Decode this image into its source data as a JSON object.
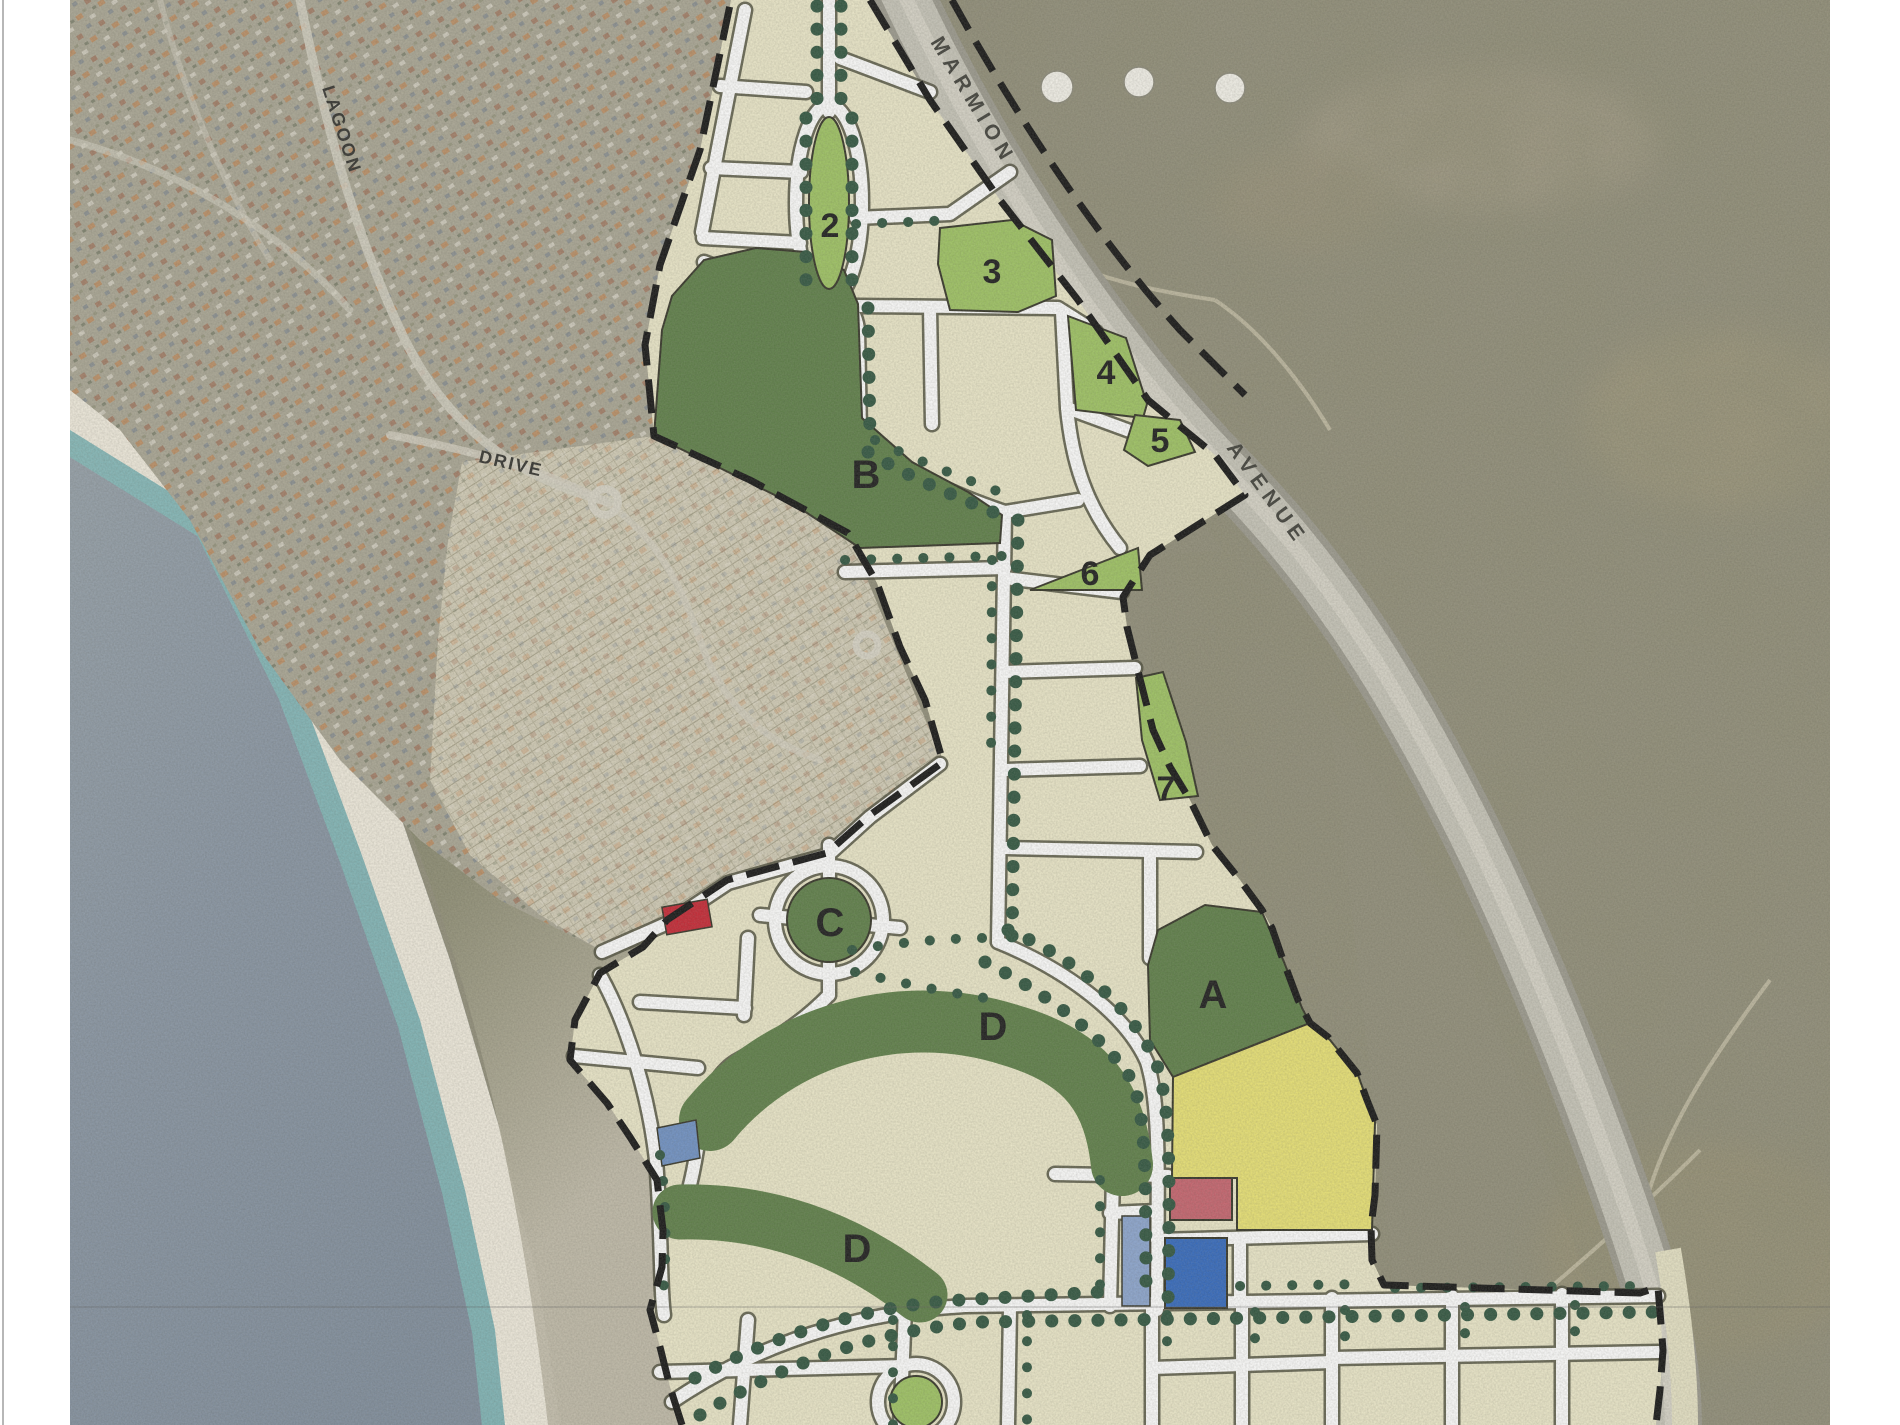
{
  "map": {
    "road_labels": {
      "marmion": "MARMION",
      "avenue": "AVENUE",
      "lagoon": "LAGOON",
      "drive": "DRIVE"
    },
    "park_labels": {
      "a": "A",
      "b": "B",
      "c": "C",
      "d_upper": "D",
      "d_lower": "D"
    },
    "area_labels": {
      "n2": "2",
      "n3": "3",
      "n4": "4",
      "n5": "5",
      "n6": "6",
      "n7": "7"
    },
    "legend_colors": {
      "open_space_dark_green": "#5a7c44",
      "reserve_light_green": "#9dc360",
      "residential_cream": "#ece8c9",
      "special_use_yellow": "#e9e272",
      "site_red": "#c5606b",
      "site_red_small": "#c5212f",
      "site_blue_dark": "#2f66bd",
      "site_blue_light": "#8aa4cf",
      "site_blue_mid": "#6c8fc4",
      "street_tree_green": "#2c523c",
      "plan_boundary_black": "#111111",
      "road_white": "#ffffff",
      "avenue_grey": "#c2c0b4",
      "ocean_blue_grey": "#8693a2",
      "nearshore_turquoise": "#7ec0bd",
      "beach_sand": "#f0ebdd",
      "bushland_olive": "#8f8c77",
      "suburb_grey_olive": "#a9a593"
    }
  }
}
